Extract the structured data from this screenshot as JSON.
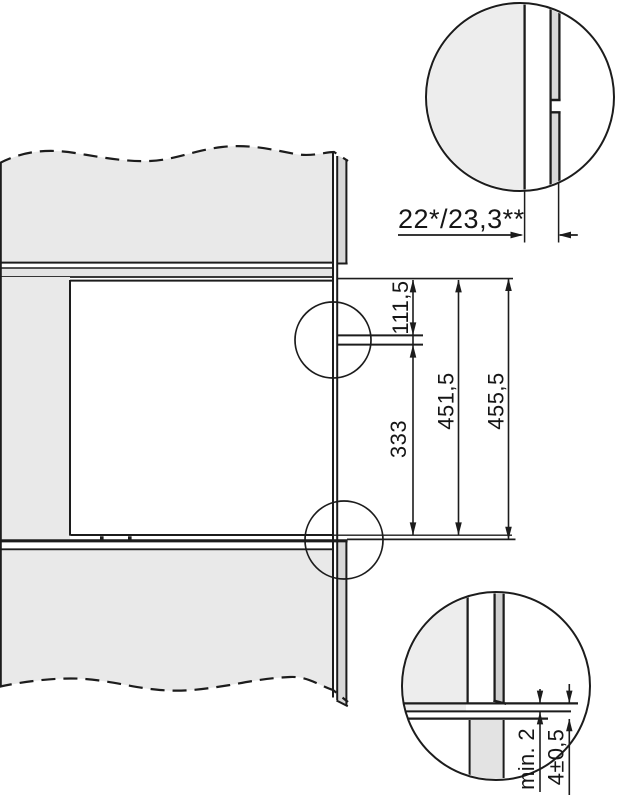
{
  "diagram": {
    "kind": "built-in-appliance-installation-dimension-drawing",
    "unit_style": "millimetres, decimal comma",
    "labels": {
      "dim_top_offset": "111,5",
      "dim_lower_section": "333",
      "dim_inner_height": "451,5",
      "dim_outer_height": "455,5",
      "dim_front_depth": "22*/23,3**",
      "dim_min_clearance": "min. 2",
      "dim_front_overlap": "4±0,5"
    },
    "colors": {
      "line": "#1c1c1c",
      "panel_fill": "#e9e9e9",
      "strip_fill": "#d8d8d8",
      "shelf_fill": "#e4e4e4",
      "detail_left_fill": "#ededed",
      "background": "#ffffff"
    }
  }
}
